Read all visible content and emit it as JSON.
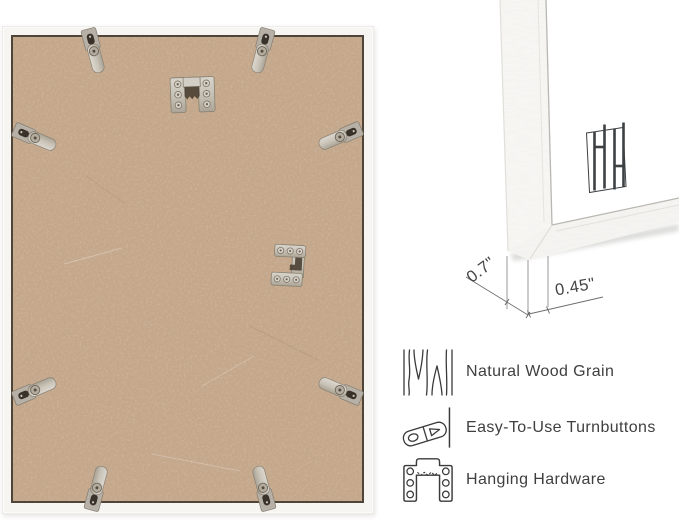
{
  "back_view": {
    "name": "frame-back-photo",
    "hardware": {
      "turnbuttons_visible": 8,
      "hangers": [
        "sawtooth-hanger",
        "keyhole-bracket-hanger"
      ]
    },
    "colors": {
      "frame_wood": "#f6f5f2",
      "mdf_backing": "#c6a98d",
      "metal_hardware": "#c8c2b8",
      "rabbet_line": "#4e4437"
    }
  },
  "corner_view": {
    "name": "frame-corner-closeup",
    "brand_logo_icon": "hh-bar-monogram-icon",
    "measurements": {
      "depth_label": "0.7\"",
      "face_label": "0.45\""
    }
  },
  "features": [
    {
      "icon": "wood-grain-icon",
      "label": "Natural Wood Grain"
    },
    {
      "icon": "turnbutton-icon",
      "label": "Easy-To-Use Turnbuttons"
    },
    {
      "icon": "hanging-hardware-icon",
      "label": "Hanging Hardware"
    }
  ],
  "text_color": "#3f3f3f"
}
